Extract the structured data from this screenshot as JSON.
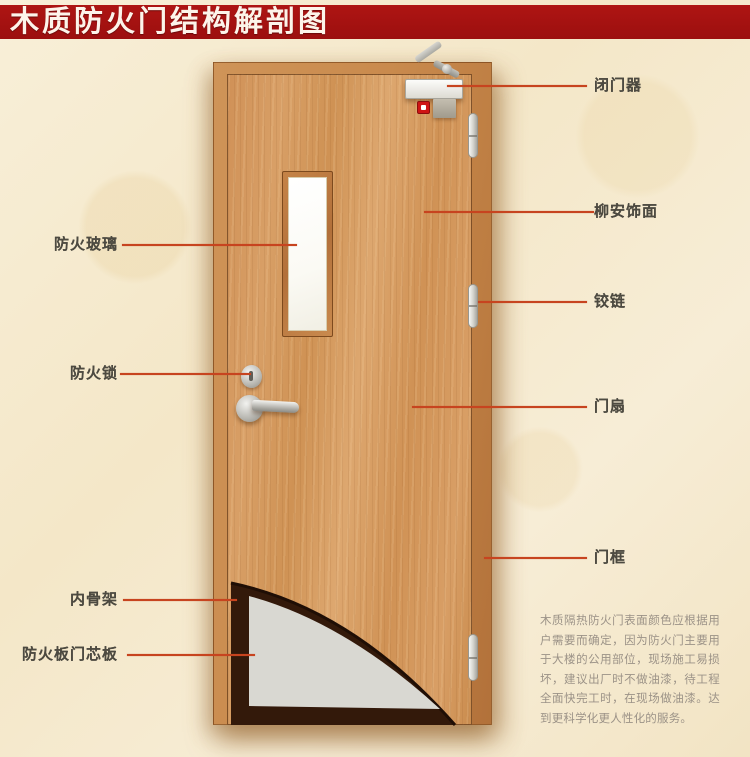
{
  "title": {
    "text": "木质防火门结构解剖图"
  },
  "labels": {
    "right": [
      {
        "name": "door-closer",
        "text": "闭门器"
      },
      {
        "name": "lauan-veneer",
        "text": "柳安饰面"
      },
      {
        "name": "hinge",
        "text": "铰链"
      },
      {
        "name": "door-leaf",
        "text": "门扇"
      },
      {
        "name": "door-frame",
        "text": "门框"
      }
    ],
    "left": [
      {
        "name": "fire-glass",
        "text": "防火玻璃"
      },
      {
        "name": "fire-lock",
        "text": "防火锁"
      },
      {
        "name": "inner-skeleton",
        "text": "内骨架"
      },
      {
        "name": "fire-board-core",
        "text": "防火板门芯板"
      }
    ]
  },
  "description": {
    "text": "木质隔热防火门表面颜色应根据用户需要而确定，因为防火门主要用于大楼的公用部位，现场施工易损坏，建议出厂时不做油漆，待工程全面快完工时，在现场做油漆。达到更科学化更人性化的服务。"
  },
  "colors": {
    "title_bar": "#9c0f0f",
    "callout_line": "#c7441f",
    "label_text": "#4d4a41",
    "background": "#f5e9cc",
    "door_frame_wood": "#c98a4d",
    "door_leaf_wood": "#d69b61",
    "core_board_gray": "#d9d8d2",
    "skeleton_dark": "#33190a",
    "alarm_red": "#cf1414"
  }
}
